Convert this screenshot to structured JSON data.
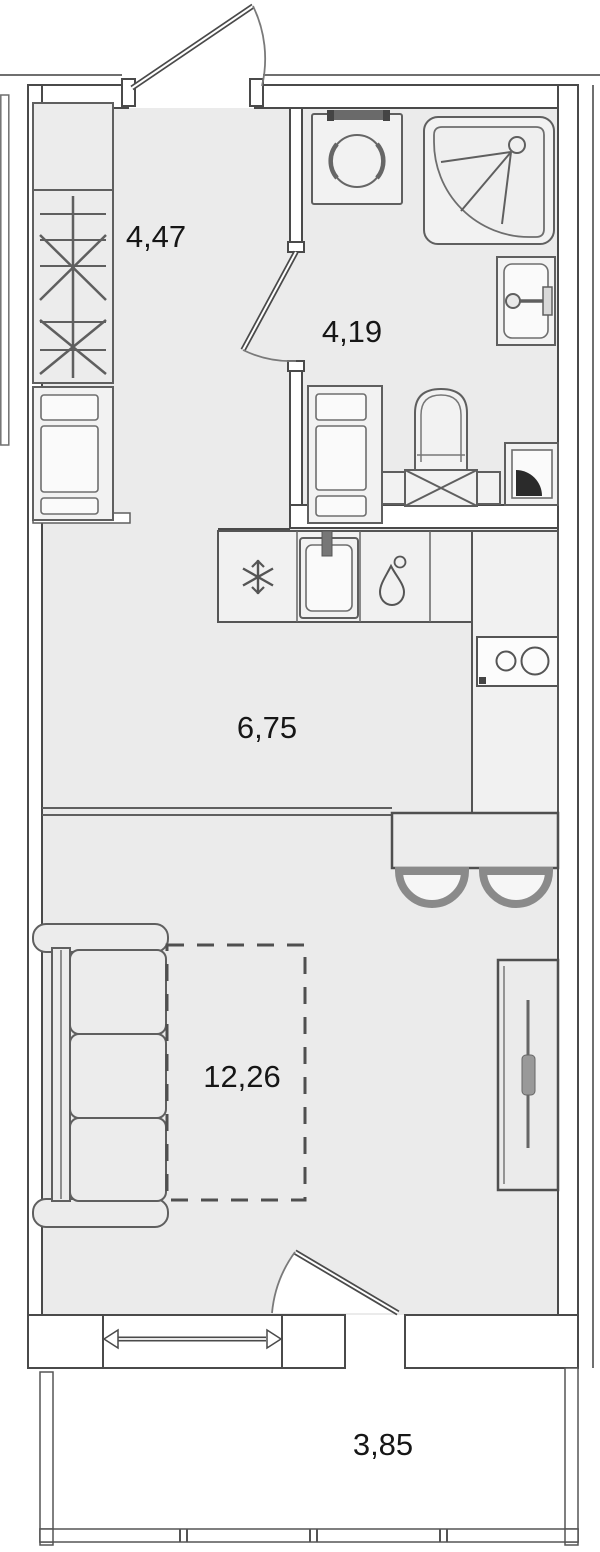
{
  "plan": {
    "rooms": [
      {
        "name": "hallway",
        "area_label": "4,47"
      },
      {
        "name": "bathroom",
        "area_label": "4,19"
      },
      {
        "name": "kitchen",
        "area_label": "6,75"
      },
      {
        "name": "living-room",
        "area_label": "12,26"
      },
      {
        "name": "balcony",
        "area_label": "3,85"
      }
    ],
    "colors": {
      "floor": "#ebebeb",
      "wall_fill": "#ffffff",
      "wall_line": "#4a4a4a",
      "furniture_line": "#5f5f5f",
      "label_text": "#161616",
      "accent_black": "#2b2b2b"
    },
    "icons": [
      "snowflake-fridge-icon",
      "water-drop-icon",
      "shower-spray-icon",
      "hanger-rail-icon",
      "stove-burners-icon"
    ]
  }
}
